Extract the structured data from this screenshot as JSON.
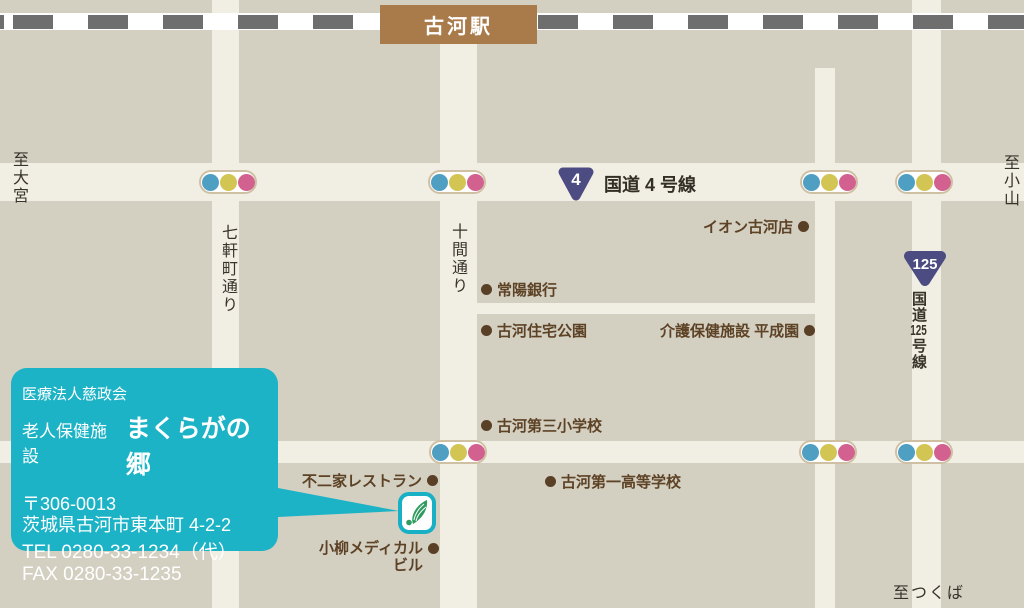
{
  "map": {
    "station": {
      "label": "古河駅"
    },
    "directions": {
      "west": "至大宮",
      "east": "至小山",
      "south": "至つくば"
    },
    "roads": {
      "route4": {
        "shield_number": "4",
        "label": "国道 4 号線"
      },
      "route125": {
        "shield_number": "125",
        "label_top": "国道",
        "label_number": "125",
        "label_bottom": "号線"
      },
      "street_shichikencho": "七軒町通り",
      "street_jukken": "十間通り"
    },
    "landmarks": [
      {
        "label": "イオン古河店"
      },
      {
        "label": "常陽銀行"
      },
      {
        "label": "古河住宅公園"
      },
      {
        "label": "介護保健施設 平成園"
      },
      {
        "label": "古河第三小学校"
      },
      {
        "label": "不二家レストラン"
      },
      {
        "label": "古河第一高等学校"
      },
      {
        "label": "小柳メディカル",
        "label_line2": "ビル"
      }
    ],
    "info_box": {
      "organization": "医療法人慈政会",
      "facility_type": "老人保健施設",
      "facility_name": "まくらがの郷",
      "postal_code": "〒306-0013",
      "address": "茨城県古河市東本町 4-2-2",
      "tel": "TEL 0280-33-1234（代）",
      "fax": "FAX 0280-33-1235"
    },
    "colors": {
      "background_tan": "#d3cfc1",
      "road_cream": "#f1efe4",
      "info_box_teal": "#1cb3c6",
      "station_brown": "#a97b4b",
      "landmark_brown": "#5d4226",
      "route_shield_indigo": "#4c4b82",
      "signal_blue": "#4f9fc2",
      "signal_yellow": "#d3c554",
      "signal_pink": "#d2618f",
      "logo_green": "#2f9b5f"
    }
  }
}
